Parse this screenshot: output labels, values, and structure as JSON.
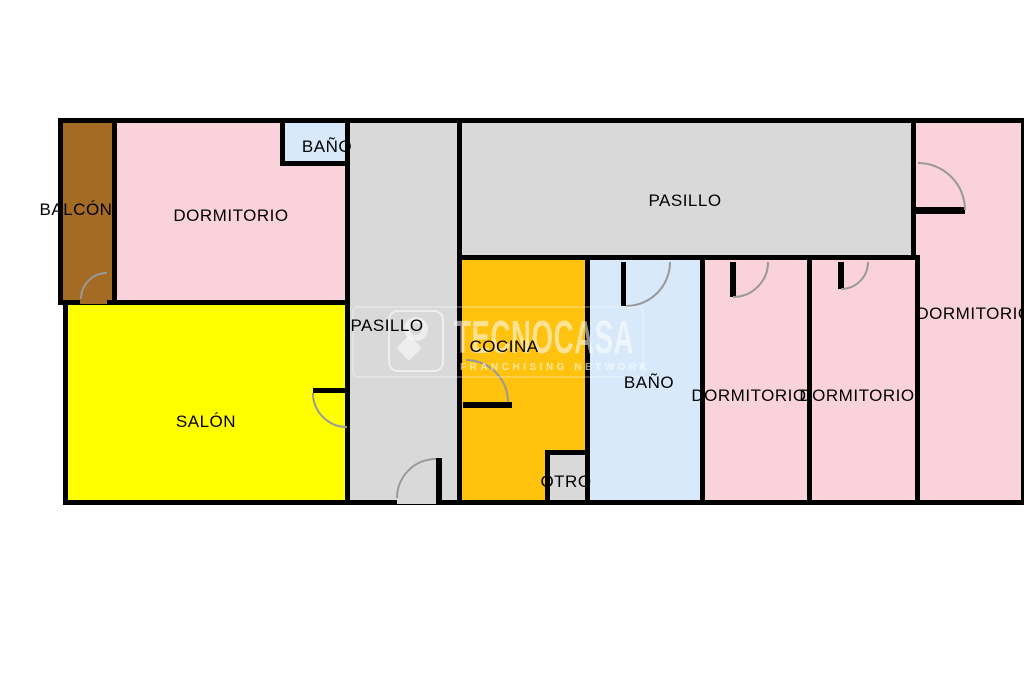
{
  "title": "floor-plan",
  "rooms": {
    "balcon": {
      "label": "BALCÓN"
    },
    "dormitorio_1": {
      "label": "DORMITORIO"
    },
    "bano_1": {
      "label": "BAÑO"
    },
    "pasillo_v": {
      "label": "PASILLO"
    },
    "pasillo_h": {
      "label": "PASILLO"
    },
    "cocina": {
      "label": "COCINA"
    },
    "bano_2": {
      "label": "BAÑO"
    },
    "dormitorio_2": {
      "label": "DORMITORIO"
    },
    "dormitorio_3": {
      "label": "DORMITORIO"
    },
    "dormitorio_4": {
      "label": "DORMITORIO"
    },
    "salon": {
      "label": "SALÓN"
    },
    "otro": {
      "label": "OTRO"
    }
  },
  "watermark": {
    "brand": "TECNOCASA",
    "tagline": "FRANCHISING NETWORK"
  },
  "colors": {
    "wall": "#000000",
    "bedroom_pink": "#FAD2DC",
    "kitchen_orange": "#FFC20E",
    "bath_blue": "#D7E9FA",
    "salon_yellow": "#FFFF00",
    "corridor_gray": "#D9D9D9",
    "balcony_brown": "#A36B24",
    "door_arc_gray": "#999999"
  }
}
